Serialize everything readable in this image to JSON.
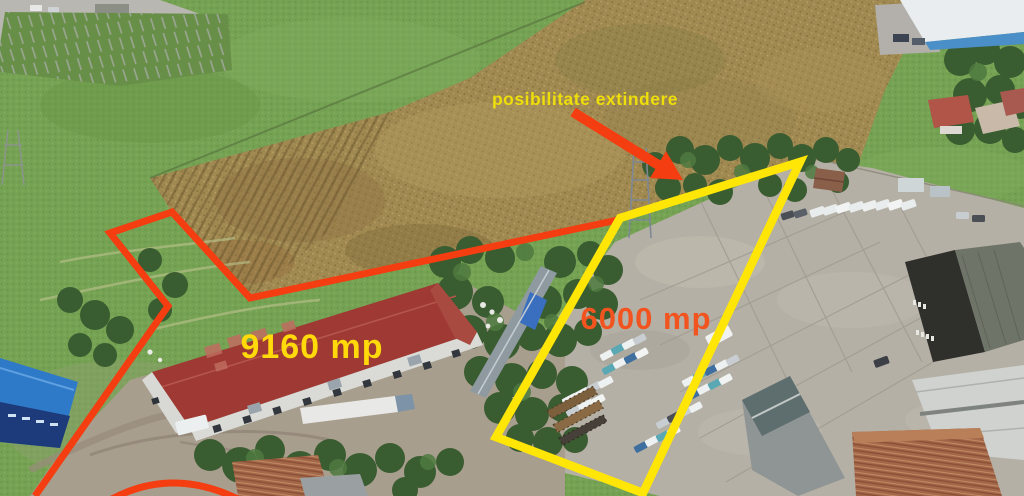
{
  "scene": {
    "type": "aerial-drone-photo",
    "description": "Aerial photo of industrial property with two land parcels outlined",
    "annotations": {
      "expansion_label": "posibilitate extindere",
      "red_parcel_area": "9160 mp",
      "yellow_parcel_area": "6000 mp"
    },
    "colors": {
      "red_annotation": "#f43d10",
      "yellow_annotation": "#ffe606",
      "expansion_label_color": "#eede0a",
      "red_parcel_label_color": "#ffd90a",
      "yellow_parcel_label_color": "#f25420"
    }
  }
}
